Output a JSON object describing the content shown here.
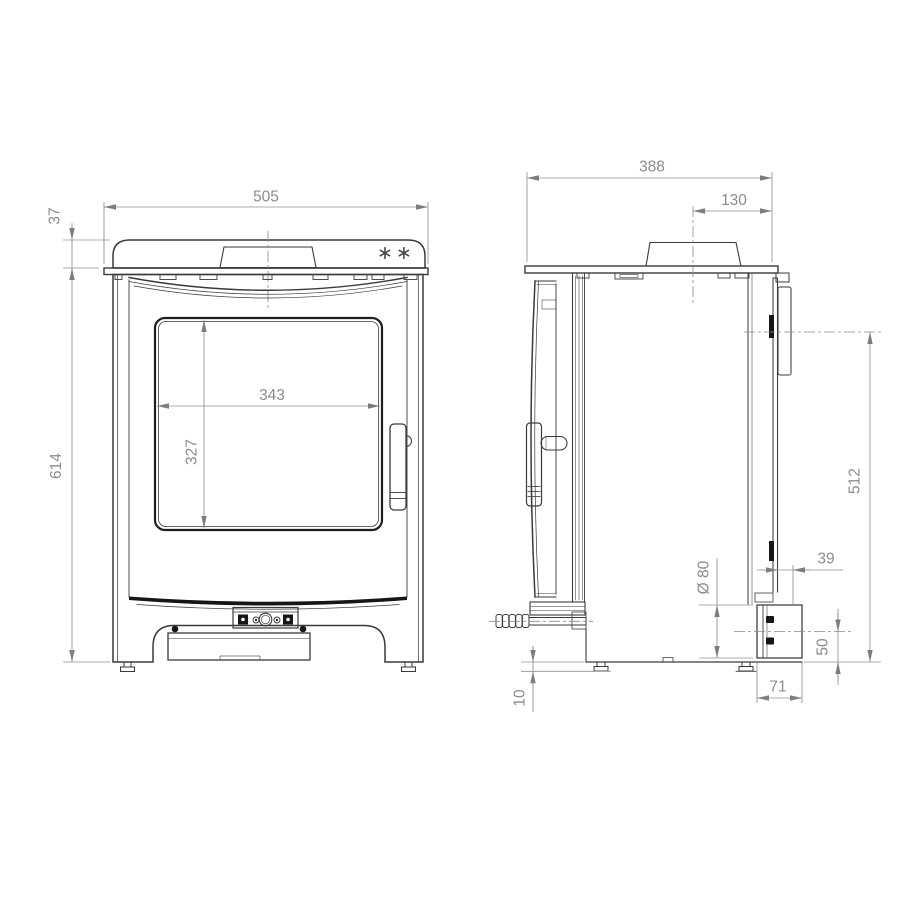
{
  "front_view": {
    "note_marker": "∗∗",
    "dims": {
      "overall_width": "505",
      "top_plate_height": "37",
      "body_height": "614",
      "glass_width": "343",
      "glass_height": "327"
    }
  },
  "side_view": {
    "dims": {
      "overall_depth": "388",
      "flue_centre_to_rear": "130",
      "rear_outlet_centre_height": "512",
      "rear_clearance": "39",
      "outlet_diameter": "Ø 80",
      "air_inlet_centre_height": "50",
      "outlet_box_depth": "71",
      "floor_clearance": "10"
    }
  },
  "style": {
    "geometry_line_color": "#3a3a3a",
    "dimension_color": "#8f8f8f",
    "background": "#ffffff"
  }
}
